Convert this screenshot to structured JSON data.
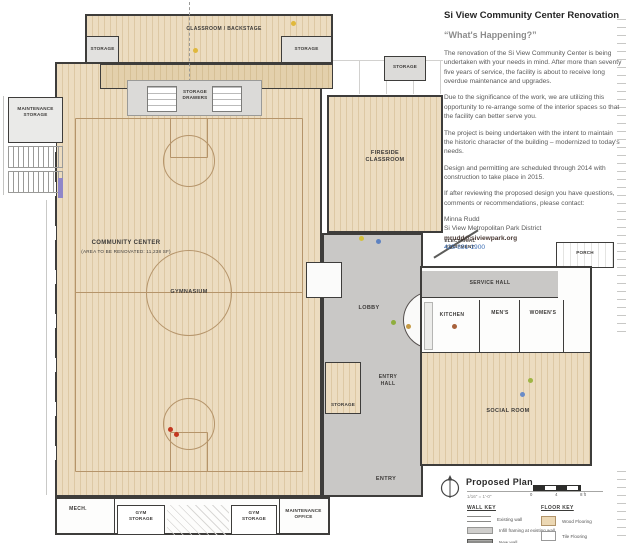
{
  "colors": {
    "wood_floor": "#ecdcc0",
    "wood_line": "#ddc8a4",
    "traffic_floor": "#c9c8c6",
    "wall_dark": "#3e3d3b",
    "court_line": "#b5946a",
    "title_text": "#262626",
    "subtitle_text": "#8c8c8c",
    "body_text": "#595959",
    "link_blue": "#3c6eb4",
    "legend_swatch_wood": "#ecd8b4",
    "legend_swatch_gray": "#b4b3b1"
  },
  "panel": {
    "title": "Si View Community Center Renovation",
    "subtitle": "“What's Happening?”",
    "paragraphs": [
      "The renovation of the Si View Community Center is being undertaken with your needs in mind.  After more than seventy five years of service, the facility is about to receive long overdue maintenance and upgrades.",
      "Due to the significance of the work, we are utilizing this opportunity to re-arrange some of the interior spaces so that the facility can better serve you.",
      "The project is being undertaken with the intent to maintain the historic character of the building – modernized to today's needs.",
      "Design and permitting are scheduled through 2014 with construction to take place in 2015.",
      "If after reviewing the proposed design you have questions, comments or recommendations, please contact:"
    ],
    "contact": {
      "name": "Minna Rudd",
      "org": "Si View Metropolitan Park District",
      "email": "mrudd@siviewpark.org",
      "phone": "425-831-1900"
    }
  },
  "plan": {
    "labels": {
      "classroom_backstage": "CLASSROOM / BACKSTAGE",
      "storage_stage_left": "STORAGE",
      "storage_stage_right": "STORAGE",
      "storage_drawers": "STORAGE\nDRAWERS",
      "storage_top_right": "STORAGE",
      "maintenance_storage": "MAINTENANCE\nSTORAGE",
      "community_center": "COMMUNITY CENTER",
      "community_center_note": "(AREA TO BE RENOVATED: 11,238 SF)",
      "gymnasium": "GYMNASIUM",
      "fireside_classroom": "FIRESIDE\nCLASSROOM",
      "electrical_equipment": "ELECTRICAL\nEQUIPMENT",
      "porch": "PORCH",
      "service_hall": "SERVICE HALL",
      "kitchen": "KITCHEN",
      "mens": "MEN'S",
      "womens": "WOMEN'S",
      "lobby": "LOBBY",
      "entry_hall": "ENTRY\nHALL",
      "storage_lobby": "STORAGE",
      "social_room": "SOCIAL ROOM",
      "entry": "ENTRY",
      "mech": "MECH.",
      "gym_storage_left": "GYM\nSTORAGE",
      "gym_storage_right": "GYM\nSTORAGE",
      "maintenance_office": "MAINTENANCE\nOFFICE"
    }
  },
  "legend": {
    "plan_title": "Proposed Plan",
    "scale_note": "1/16\" = 1'-0\"",
    "scale_ticks": [
      "0",
      "4",
      "8 ft"
    ],
    "wall_key": {
      "title": "WALL KEY",
      "items": [
        "Existing wall",
        "Infill framing at existing wall",
        "New wall"
      ]
    },
    "floor_key": {
      "title": "FLOOR KEY",
      "items": [
        "Wood Flooring",
        "Tile Flooring",
        "High Traffic Flooring (TBD)"
      ]
    }
  }
}
